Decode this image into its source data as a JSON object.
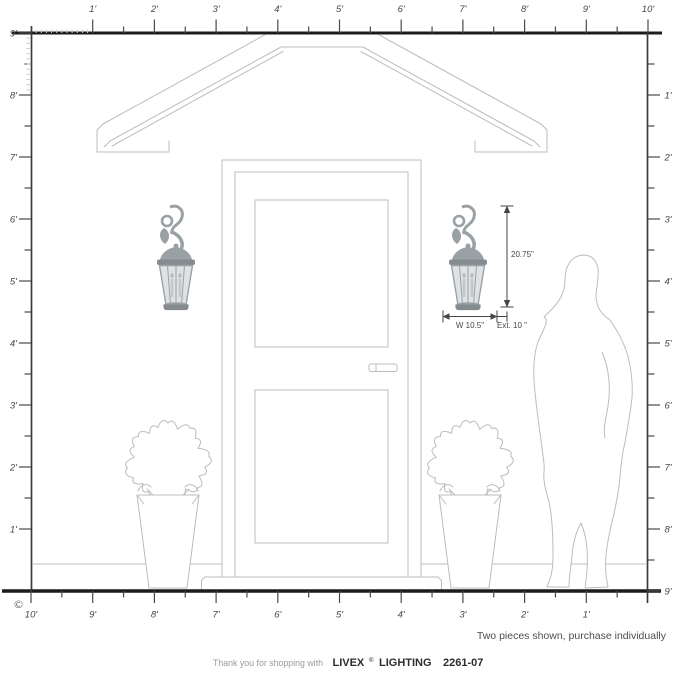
{
  "copyright": "©",
  "note": "Two pieces shown, purchase individually",
  "footer": {
    "prefix": "Thank you for shopping with",
    "brand": "LIVEX",
    "reg": "®",
    "suffix": "LIGHTING",
    "model": "2261-07"
  },
  "dimensions": {
    "height": "20.75\"",
    "width": "W 10.5\"",
    "extension": "Ext. 10 \""
  },
  "rulers": {
    "unit": "feet",
    "top": [
      "1'",
      "2'",
      "3'",
      "4'",
      "5'",
      "6'",
      "7'",
      "8'",
      "9'",
      "10'"
    ],
    "left": [
      "9'",
      "8'",
      "7'",
      "6'",
      "5'",
      "4'",
      "3'",
      "2'",
      "1'"
    ],
    "right": [
      "1'",
      "2'",
      "3'",
      "4'",
      "5'",
      "6'",
      "7'",
      "8'",
      "9'"
    ],
    "bottom": [
      "10'",
      "9'",
      "8'",
      "7'",
      "6'",
      "5'",
      "4'",
      "3'",
      "2'",
      "1'"
    ]
  },
  "scene": {
    "icons": {
      "lantern": "wall-lantern-icon",
      "silhouette": "female-silhouette",
      "shrub": "potted-shrub",
      "door": "front-door",
      "roof": "portico-gable-roof",
      "ruler": "scale-ruler"
    }
  },
  "colors": {
    "outline": "#b9bdbf",
    "ruler_line": "#1c1c1c",
    "tick": "#4a4a4a",
    "minor_tick": "#cccccc",
    "label": "#474747",
    "dim": "#454545",
    "lantern_frame": "#9aa1a5",
    "lantern_dark": "#858c90",
    "lantern_glass": "#dfe2e4"
  }
}
